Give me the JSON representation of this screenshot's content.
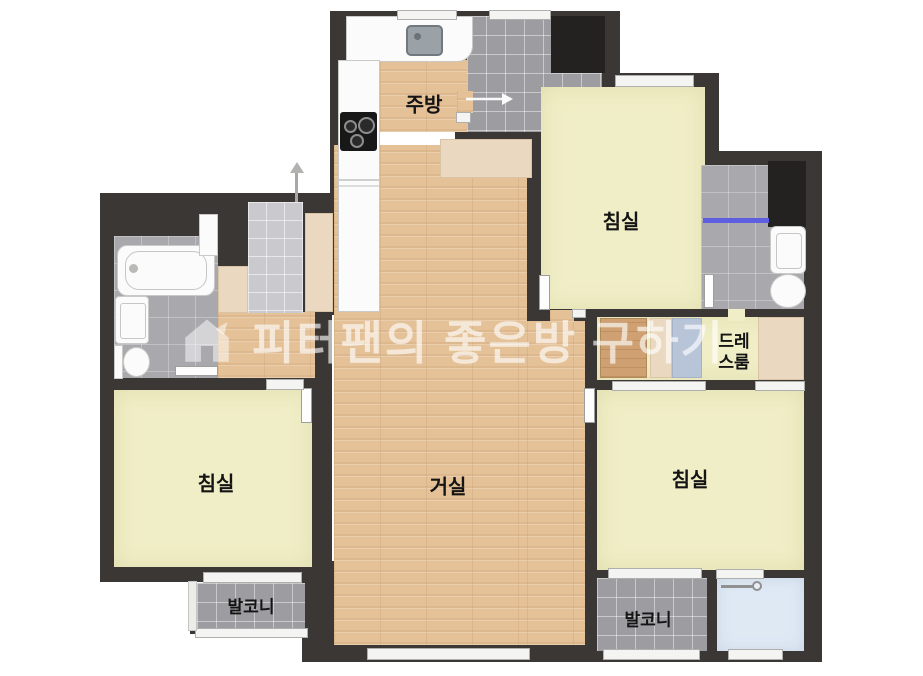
{
  "watermark": {
    "text": "피터팬의 좋은방 구하기",
    "logo": "house-icon"
  },
  "rooms": {
    "kitchen": {
      "label": "주방"
    },
    "bedroom_top_right": {
      "label": "침실"
    },
    "bedroom_left": {
      "label": "침실"
    },
    "bedroom_bottom_right": {
      "label": "침실"
    },
    "living_room": {
      "label": "거실"
    },
    "balcony_left": {
      "label": "발코니"
    },
    "balcony_right": {
      "label": "발코니"
    },
    "dressing_room": {
      "label_line1": "드레",
      "label_line2": "스룸"
    }
  },
  "icons": {
    "entrance": "entrance-direction-arrow",
    "pantry_door": "door-swing-arrow",
    "watermark_logo": "house-icon"
  },
  "colors": {
    "wall": "#3a3734",
    "closet": "#232220",
    "room_yellow": "#f0eec6",
    "wood_floor": "#e4c197",
    "tile_gray": "#9c9ca1",
    "tile_bath": "#a9a9ad",
    "tile_light": "#cacace",
    "utility_blue": "#dfe9f4",
    "cabinet_beige": "#ead9c0",
    "cabinet_blue": "#b8c4d8",
    "shower_accent": "#5e5ee0"
  }
}
